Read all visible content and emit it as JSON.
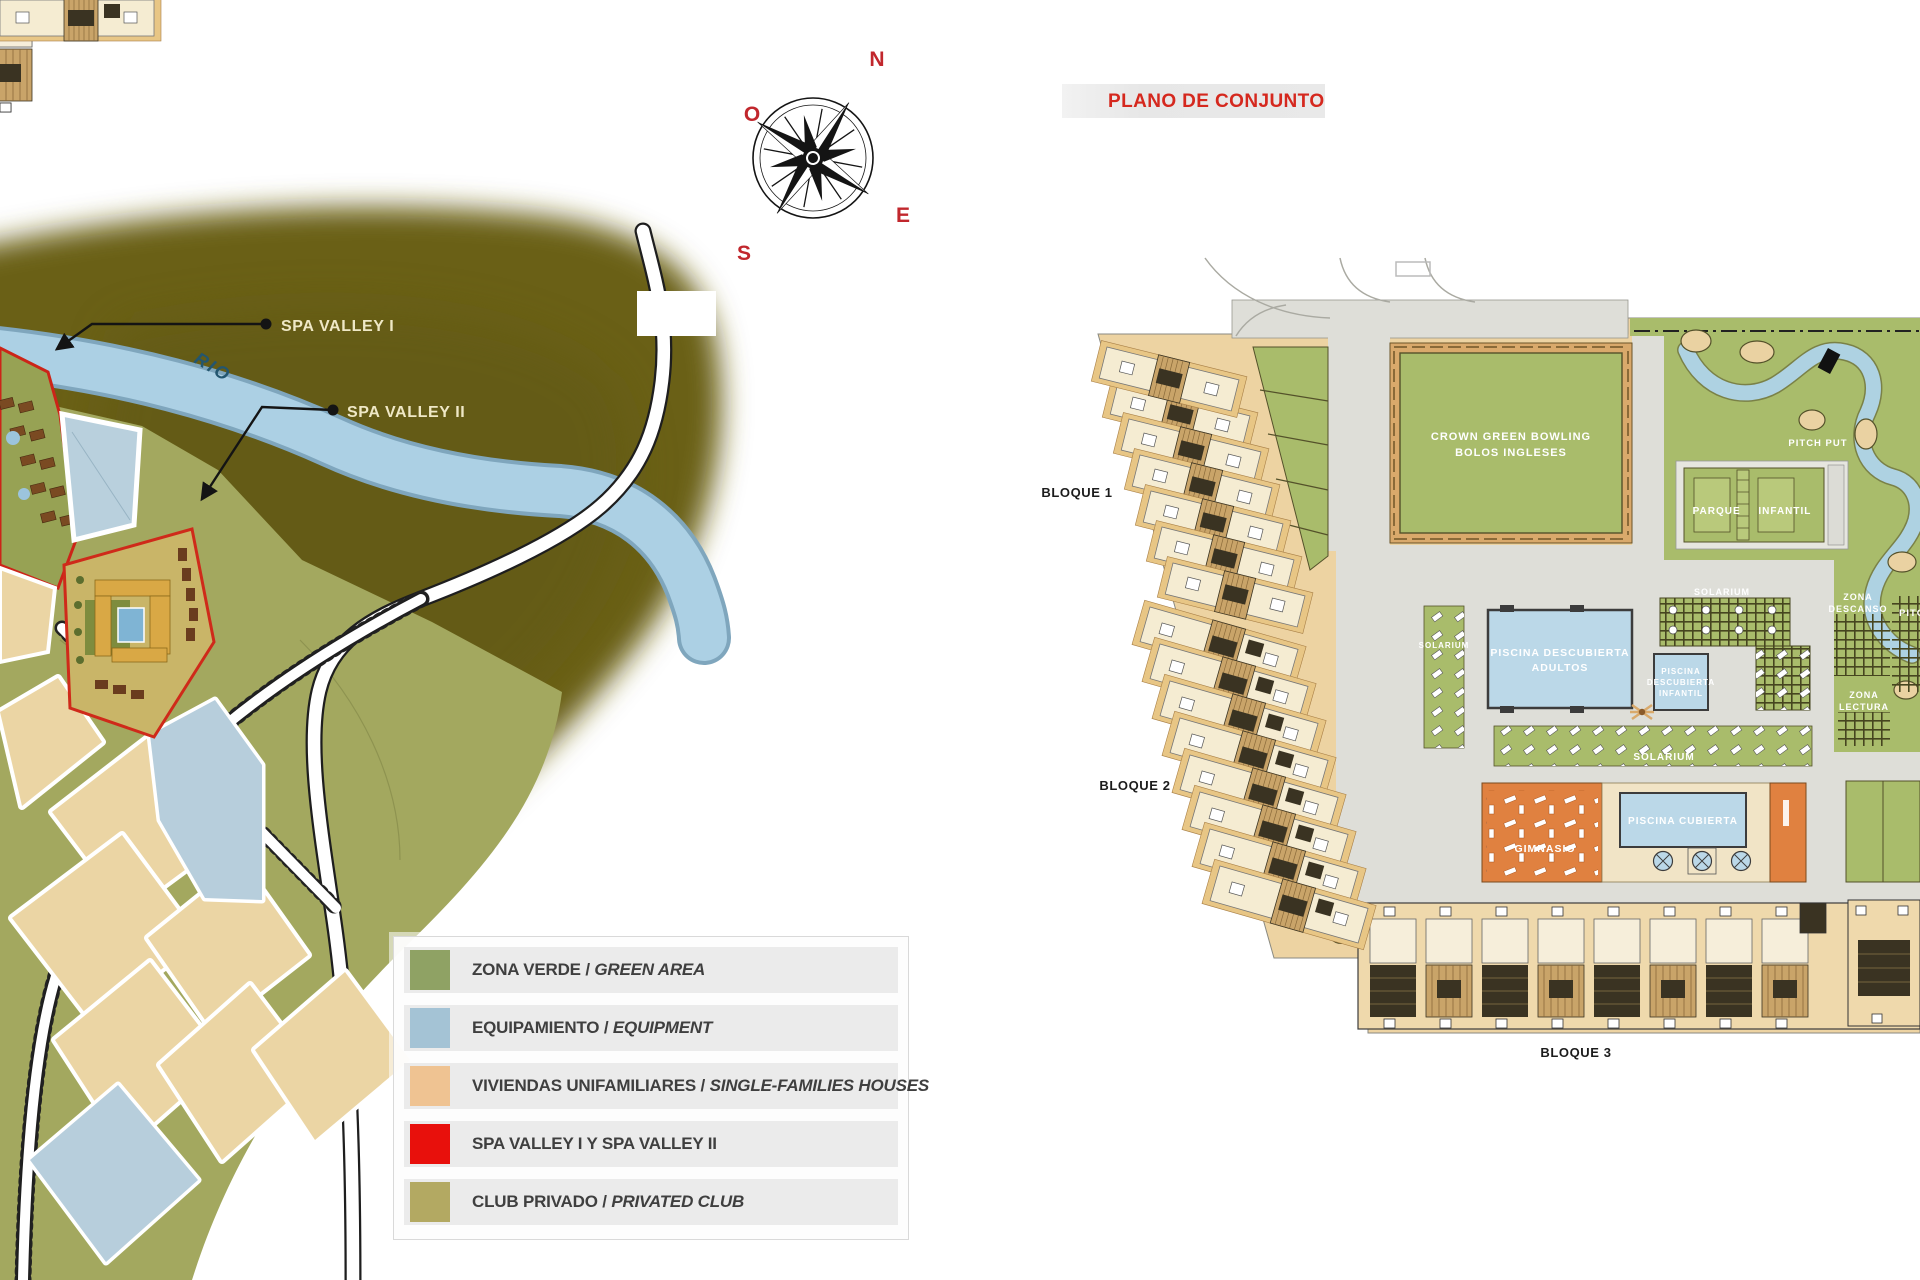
{
  "map": {
    "river_label": "RIO",
    "compass": {
      "n": "N",
      "e": "E",
      "s": "S",
      "o": "O"
    },
    "callout_spa1": "SPA VALLEY I",
    "callout_spa2": "SPA VALLEY II",
    "legend": {
      "items": [
        {
          "es": "ZONA VERDE",
          "sep": " / ",
          "en": "GREEN AREA",
          "color": "#8FA264"
        },
        {
          "es": "EQUIPAMIENTO",
          "sep": " / ",
          "en": "EQUIPMENT",
          "color": "#A4C3D5"
        },
        {
          "es": "VIVIENDAS UNIFAMILIARES",
          "sep": " / ",
          "en": "SINGLE-FAMILIES HOUSES",
          "color": "#EFC392"
        },
        {
          "es": "SPA VALLEY I Y SPA VALLEY II",
          "sep": "",
          "en": "",
          "color": "#E8100C"
        },
        {
          "es": "CLUB PRIVADO",
          "sep": " / ",
          "en": "PRIVATED CLUB",
          "color": "#B3A962"
        }
      ]
    }
  },
  "plan": {
    "title": "PLANO DE CONJUNTO",
    "bloque1": "BLOQUE 1",
    "bloque2": "BLOQUE 2",
    "bloque3": "BLOQUE 3",
    "bowling1": "CROWN GREEN BOWLING",
    "bowling2": "BOLOS INGLESES",
    "pitch_put": "PITCH PUT",
    "parque_infantil": "PARQUE INFANTIL",
    "solarium": "SOLARIUM",
    "zona": "ZONA",
    "descanso": "DESCANSO",
    "lectura": "LECTURA",
    "pitch": "PITCH",
    "piscina_descubierta": "PISCINA DESCUBIERTA",
    "adultos": "ADULTOS",
    "piscina": "PISCINA",
    "descubierta": "DESCUBIERTA",
    "infantil": "INFANTIL",
    "gimnasio": "GIMNASIO",
    "piscina_cubierta": "PISCINA CUBIERTA"
  }
}
